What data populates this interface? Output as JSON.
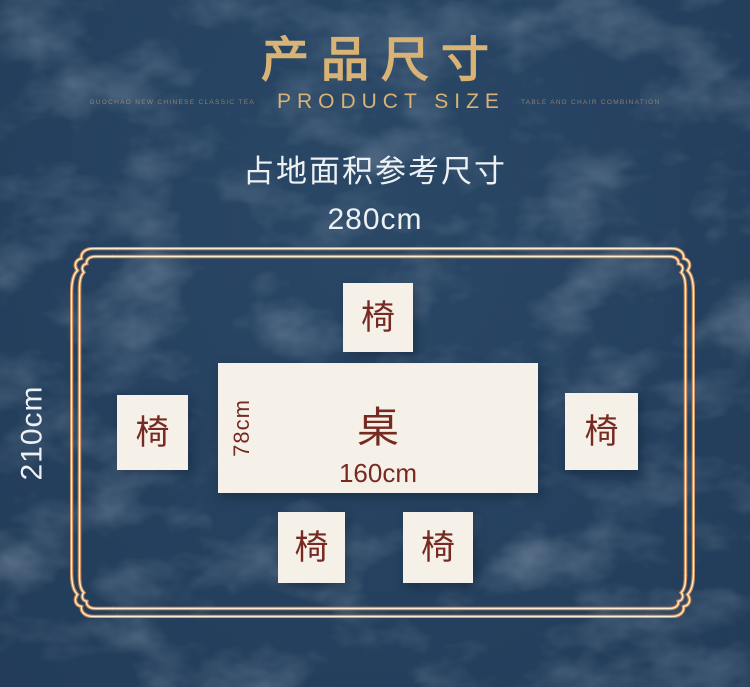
{
  "header": {
    "title": "产品尺寸",
    "subtitle": "PRODUCT SIZE",
    "tagline_left": "GUOCHAO NEW CHINESE CLASSIC TEA",
    "tagline_right": "TABLE AND CHAIR COMBINATION"
  },
  "diagram": {
    "caption": "占地面积参考尺寸",
    "overall_width": "280cm",
    "overall_depth": "210cm",
    "table": {
      "label": "桌",
      "width": "160cm",
      "depth": "78cm"
    },
    "chairs": [
      {
        "position": "top",
        "label": "椅"
      },
      {
        "position": "left",
        "label": "椅"
      },
      {
        "position": "right",
        "label": "椅"
      },
      {
        "position": "bottom-left",
        "label": "椅"
      },
      {
        "position": "bottom-right",
        "label": "椅"
      }
    ]
  },
  "colors": {
    "background": "#25415f",
    "gold": "#d9b275",
    "frame_copper": "#c2824f",
    "frame_cream": "#fdeccb",
    "panel_cream": "#f6f1e8",
    "label_maroon": "#772a21",
    "text_white": "#eef1f4"
  }
}
